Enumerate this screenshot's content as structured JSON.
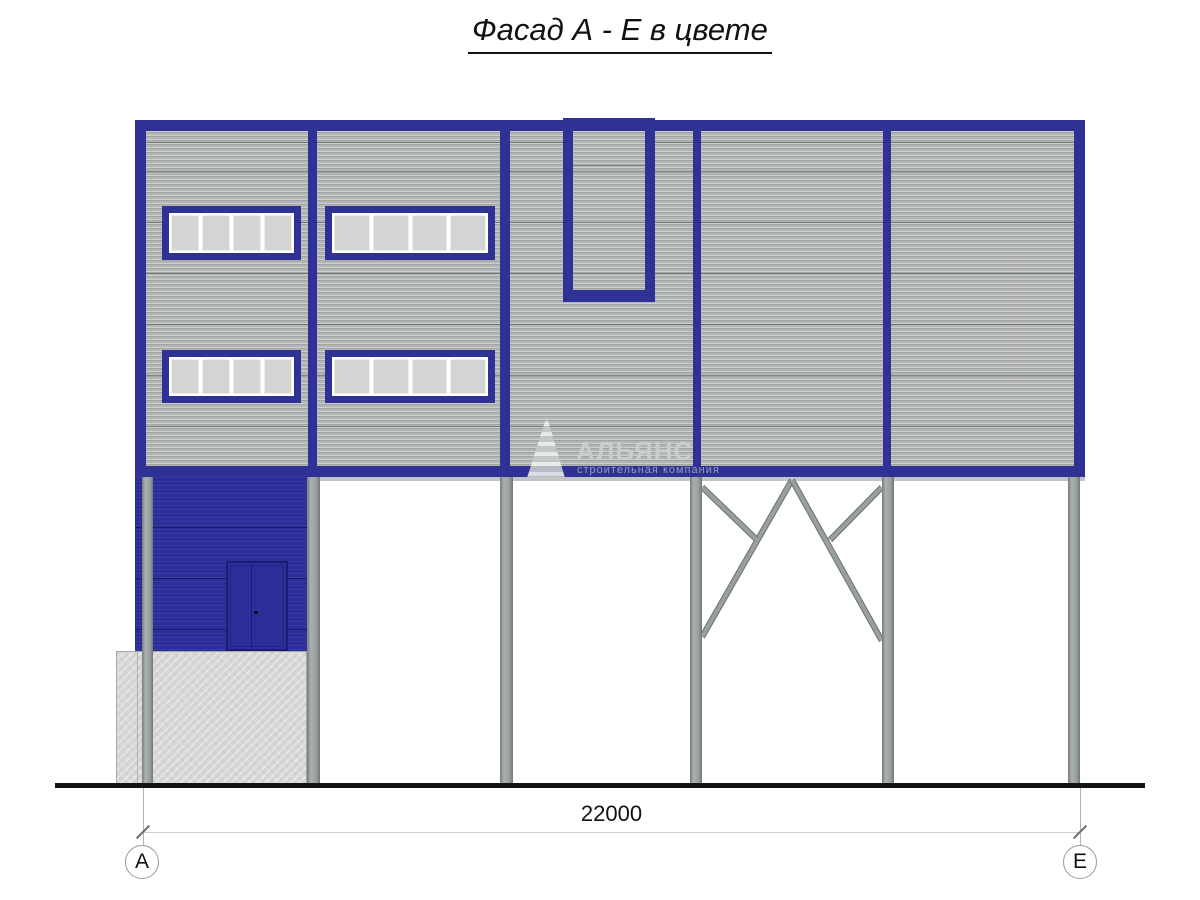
{
  "title": "Фасад А - Е в цвете",
  "watermark": {
    "brand": "АЛЬЯНС",
    "tagline": "строительная компания"
  },
  "dimension": {
    "value": "22000",
    "axis_start": "А",
    "axis_end": "Е"
  },
  "colors": {
    "frame_blue": "#2f3194",
    "entrance_wall_blue": "#2b2d98",
    "panel_gray": "#b2b5b4",
    "window_pane_gray": "#d4d6d5",
    "column_gray": "#99a09f",
    "concrete_gray": "#d7d7d5",
    "ground_black": "#141414"
  }
}
